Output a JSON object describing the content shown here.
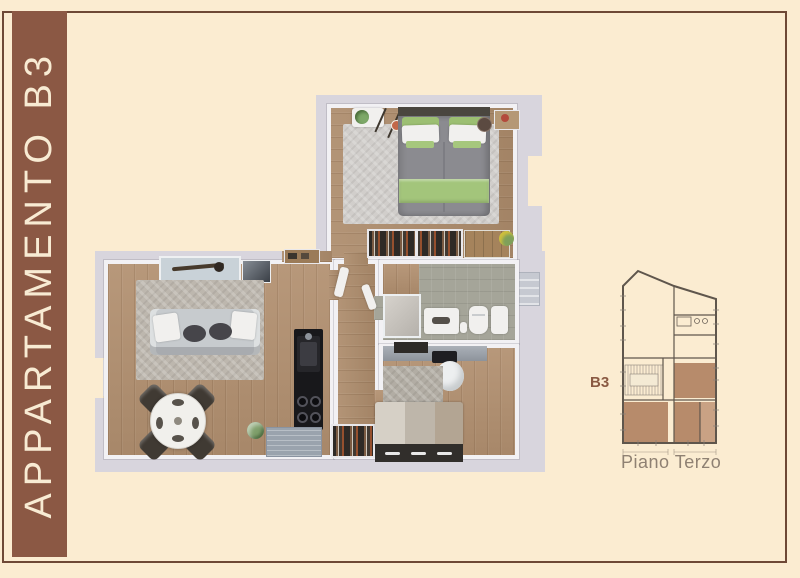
{
  "page": {
    "background_color": "#fbecd1",
    "frame_border_color": "#6e4936"
  },
  "banner": {
    "label": "APPARTAMENTO B3",
    "background_color": "#8b5844",
    "text_color": "#f8ebd3"
  },
  "floorplan": {
    "style": "3d-top-down-render",
    "wall_color": "#f2f1f4",
    "ground_color": "#d8d5dd",
    "wood_color": "#b29070",
    "accent_green": "#a3c57b"
  },
  "schematic": {
    "label": "B3",
    "caption": "Piano Terzo",
    "label_color": "#8a5a43",
    "caption_color": "#8f8173",
    "room_fill": "#b78b6b",
    "room_fill_light": "#c9a284",
    "line_color": "#5f564c"
  }
}
